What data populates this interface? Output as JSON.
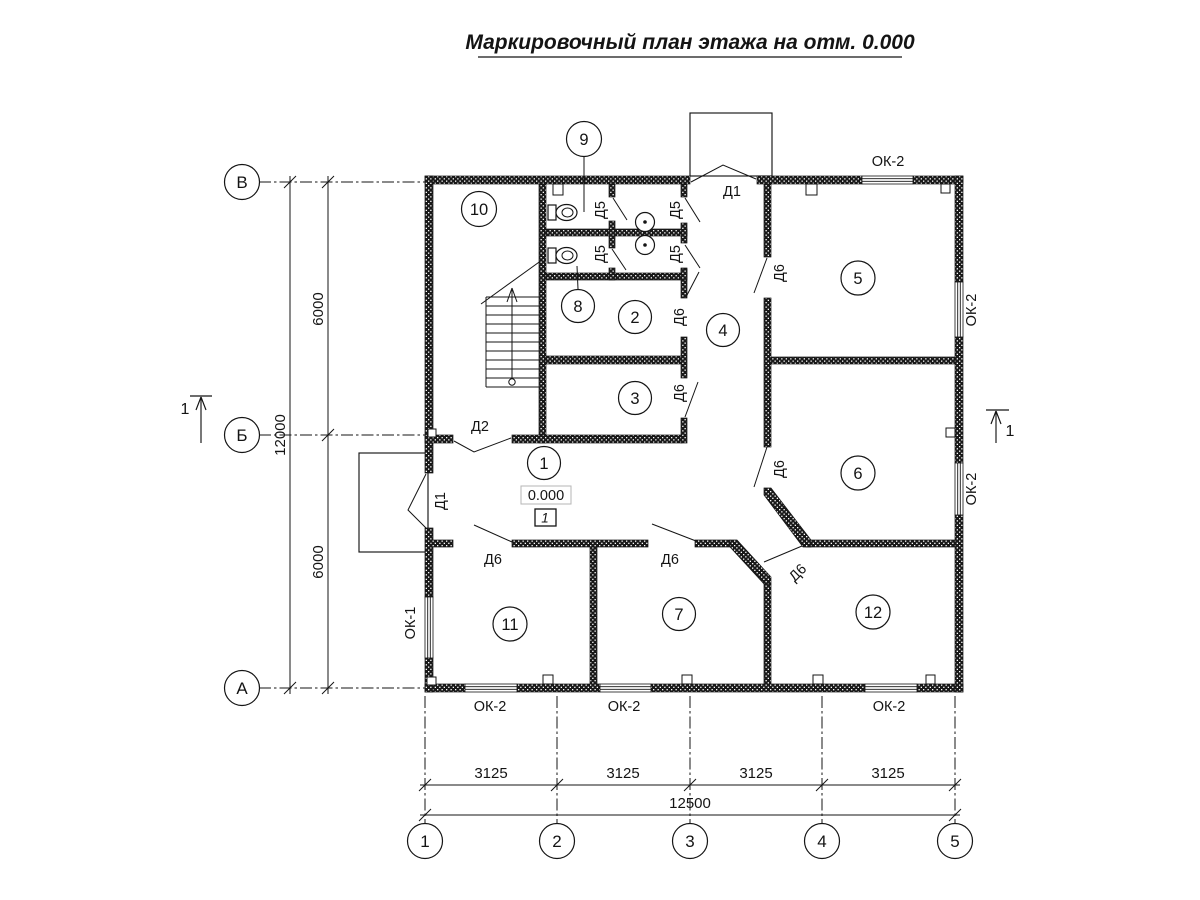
{
  "title": "Маркировочный план этажа на отм. 0.000",
  "axes": {
    "rows": [
      "В",
      "Б",
      "А"
    ],
    "cols": [
      "1",
      "2",
      "3",
      "4",
      "5"
    ]
  },
  "dimensions": {
    "left": {
      "segments": [
        "6000",
        "6000"
      ],
      "total": "12000"
    },
    "bottom": {
      "segments": [
        "3125",
        "3125",
        "3125",
        "3125"
      ],
      "total": "12500"
    }
  },
  "rooms": {
    "r1": "1",
    "r2": "2",
    "r3": "3",
    "r4": "4",
    "r5": "5",
    "r6": "6",
    "r7": "7",
    "r8": "8",
    "r9": "9",
    "r10": "10",
    "r11": "11",
    "r12": "12"
  },
  "doors": {
    "d1": "Д1",
    "d2": "Д2",
    "d5": "Д5",
    "d6": "Д6"
  },
  "windows": {
    "ok1": "ОК-1",
    "ok2": "ОК-2"
  },
  "elevation": {
    "value": "0.000",
    "floor": "1"
  },
  "section": {
    "mark": "1"
  }
}
